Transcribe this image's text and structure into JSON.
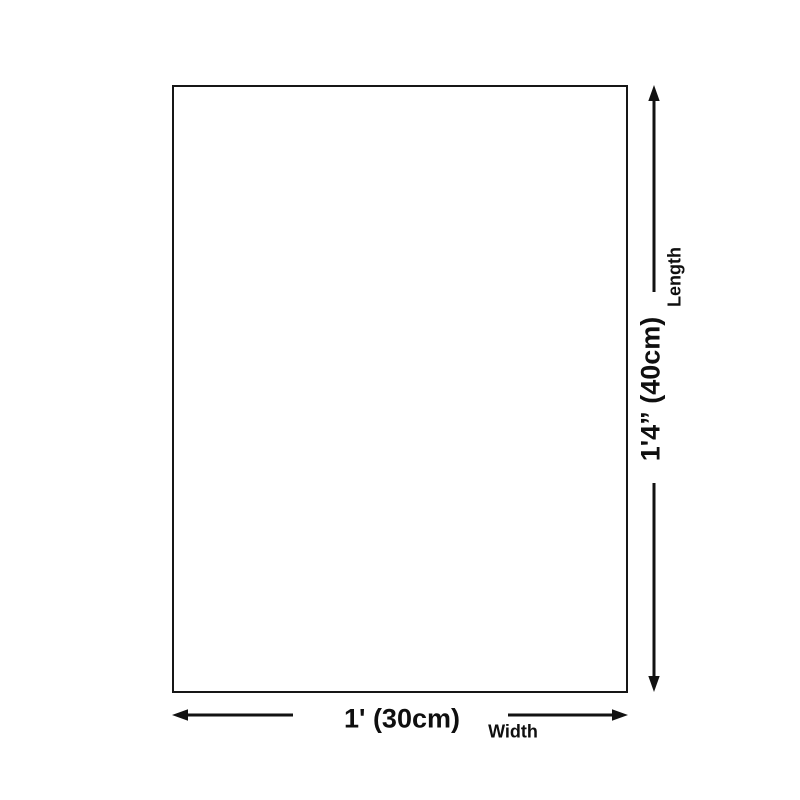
{
  "dimension_diagram": {
    "colors": {
      "background": "#ffffff",
      "line": "#121212",
      "text": "#0f0f0f"
    },
    "length": {
      "value": "1'4” (40cm)",
      "label": "Length"
    },
    "width": {
      "value": "1' (30cm)",
      "label": "Width"
    },
    "icons": {
      "vertical_arrow_top": "arrow-up-icon",
      "vertical_arrow_bottom": "arrow-down-icon",
      "horizontal_arrow_left": "arrow-left-icon",
      "horizontal_arrow_right": "arrow-right-icon"
    }
  }
}
